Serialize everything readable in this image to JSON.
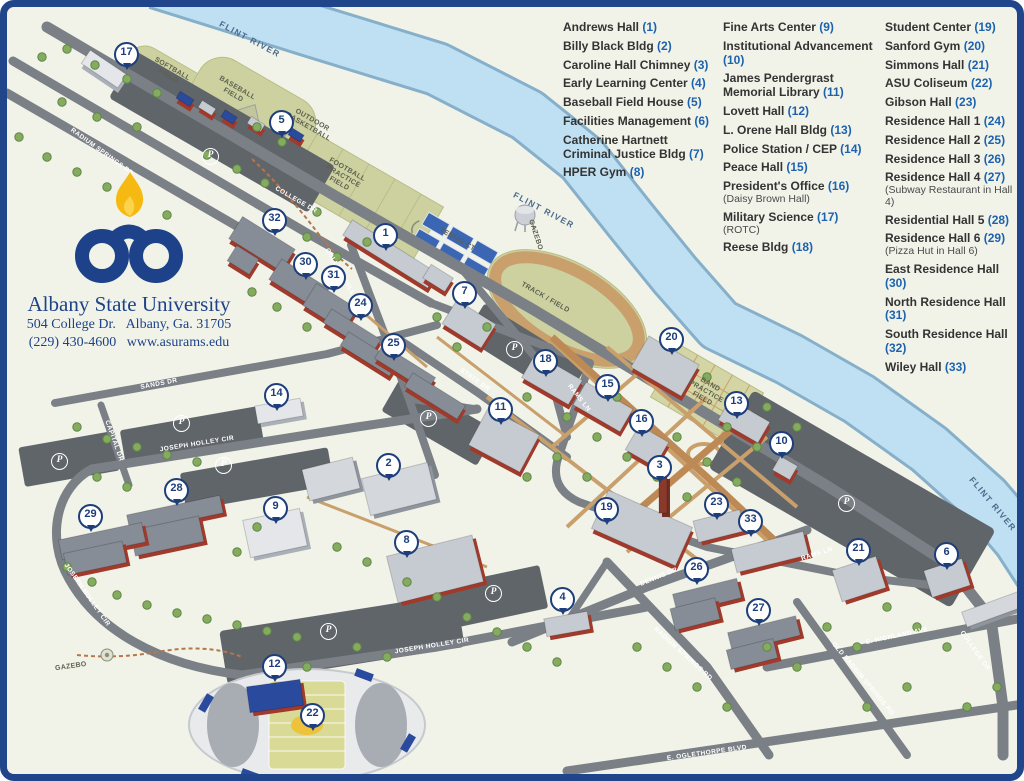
{
  "brand": {
    "title": "Albany State University",
    "address": "504 College Dr.   Albany, Ga. 31705",
    "contact": "(229) 430-4600   www.asurams.edu"
  },
  "colors": {
    "border_navy": "#20458a",
    "logo_navy": "#1d4289",
    "flame_gold": "#f6b912",
    "legend_number_blue": "#1d62ae",
    "legend_name": "#333333",
    "river_fill": "#bfe0f3",
    "river_edge": "#86afc9",
    "road_gray": "#7b8086",
    "parking_gray": "#60656a",
    "field_olive": "#cdd1a0",
    "walkway_tan": "#c9a06b",
    "brick_red": "#a23a2c",
    "roof_gray": "#c6cad1",
    "marker_navy": "#1d3e7a"
  },
  "legend": {
    "columns": [
      {
        "items": [
          {
            "name": "Andrews Hall",
            "num": "1"
          },
          {
            "name": "Billy Black Bldg",
            "num": "2"
          },
          {
            "name": "Caroline Hall Chimney",
            "num": "3"
          },
          {
            "name": "Early Learning Center",
            "num": "4"
          },
          {
            "name": "Baseball Field House",
            "num": "5"
          },
          {
            "name": "Facilities Management",
            "num": "6"
          },
          {
            "name": "Catherine Hartnett Criminal Justice Bldg",
            "num": "7"
          },
          {
            "name": "HPER Gym",
            "num": "8"
          }
        ]
      },
      {
        "items": [
          {
            "name": "Fine Arts Center",
            "num": "9"
          },
          {
            "name": "Institutional Advancement",
            "num": "10"
          },
          {
            "name": "James Pendergrast Memorial Library",
            "num": "11"
          },
          {
            "name": "Lovett Hall",
            "num": "12"
          },
          {
            "name": "L. Orene Hall Bldg",
            "num": "13"
          },
          {
            "name": "Police Station / CEP",
            "num": "14"
          },
          {
            "name": "Peace Hall",
            "num": "15"
          },
          {
            "name": "President's Office",
            "num": "16",
            "note": "(Daisy Brown Hall)"
          },
          {
            "name": "Military Science",
            "num": "17",
            "note": "(ROTC)"
          },
          {
            "name": "Reese Bldg",
            "num": "18"
          }
        ]
      },
      {
        "items": [
          {
            "name": "Student Center",
            "num": "19"
          },
          {
            "name": "Sanford Gym",
            "num": "20"
          },
          {
            "name": "Simmons Hall",
            "num": "21"
          },
          {
            "name": "ASU Coliseum",
            "num": "22"
          },
          {
            "name": "Gibson Hall",
            "num": "23"
          },
          {
            "name": "Residence Hall 1",
            "num": "24"
          },
          {
            "name": "Residence Hall 2",
            "num": "25"
          },
          {
            "name": "Residence Hall 3",
            "num": "26"
          },
          {
            "name": "Residence Hall 4",
            "num": "27",
            "note": "(Subway Restaurant in Hall 4)"
          },
          {
            "name": "Residential Hall 5",
            "num": "28"
          },
          {
            "name": "Residence Hall 6",
            "num": "29",
            "note": "(Pizza Hut in Hall 6)"
          },
          {
            "name": "East Residence Hall",
            "num": "30"
          },
          {
            "name": "North Residence Hall",
            "num": "31"
          },
          {
            "name": "South Residence Hall",
            "num": "32"
          },
          {
            "name": "Wiley Hall",
            "num": "33"
          }
        ]
      }
    ]
  },
  "map": {
    "river_labels": [
      {
        "t": "FLINT RIVER",
        "x": 243,
        "y": 32,
        "r": 28
      },
      {
        "t": "FLINT RIVER",
        "x": 537,
        "y": 203,
        "r": 28
      },
      {
        "t": "FLINT RIVER",
        "x": 986,
        "y": 497,
        "r": 50
      }
    ],
    "road_labels": [
      {
        "t": "RADIUM SPRINGS RD",
        "x": 95,
        "y": 145,
        "r": 36
      },
      {
        "t": "COLLEGE DR",
        "x": 289,
        "y": 193,
        "r": 30
      },
      {
        "t": "COLLEGE HILLS LN",
        "x": 337,
        "y": 272,
        "r": 60
      },
      {
        "t": "SANDS DR",
        "x": 152,
        "y": 377,
        "r": -11
      },
      {
        "t": "CAPITAL DR",
        "x": 107,
        "y": 434,
        "r": 70
      },
      {
        "t": "JOSEPH HOLLEY CIR",
        "x": 190,
        "y": 437,
        "r": -9
      },
      {
        "t": "JOSEPH HOLLEY CIR",
        "x": 80,
        "y": 588,
        "r": 55
      },
      {
        "t": "JOSEPH HOLLEY CIR",
        "x": 425,
        "y": 639,
        "r": -9
      },
      {
        "t": "STATE DR",
        "x": 468,
        "y": 373,
        "r": 35
      },
      {
        "t": "RAMS LN",
        "x": 572,
        "y": 391,
        "r": 52
      },
      {
        "t": "RAMS LN",
        "x": 810,
        "y": 547,
        "r": -18
      },
      {
        "t": "DENNIS DR",
        "x": 652,
        "y": 570,
        "r": -22
      },
      {
        "t": "E. HIGHLAND AVE",
        "x": 890,
        "y": 629,
        "r": -12
      },
      {
        "t": "RADIUM SPRINGS RD",
        "x": 676,
        "y": 647,
        "r": 42
      },
      {
        "t": "OLD RADIUM SPRINGS RD",
        "x": 856,
        "y": 672,
        "r": 50
      },
      {
        "t": "COLLEGE DR",
        "x": 968,
        "y": 644,
        "r": 55
      },
      {
        "t": "E. OGLETHORPE BLVD",
        "x": 700,
        "y": 746,
        "r": -8
      }
    ],
    "field_labels": [
      {
        "t": "SOFTBALL\nFIELD",
        "x": 163,
        "y": 66,
        "r": 30
      },
      {
        "t": "BASEBALL\nFIELD",
        "x": 228,
        "y": 85,
        "r": 30
      },
      {
        "t": "OUTDOOR\nBASKETBALL",
        "x": 303,
        "y": 117,
        "r": 30
      },
      {
        "t": "FOOTBALL\nPRACTICE\nFIELD",
        "x": 336,
        "y": 170,
        "r": 30
      },
      {
        "t": "TENNIS CT",
        "x": 450,
        "y": 233,
        "r": 30
      },
      {
        "t": "TRACK / FIELD",
        "x": 538,
        "y": 291,
        "r": 30
      },
      {
        "t": "BAND\nPRACTICE\nFIELD",
        "x": 699,
        "y": 385,
        "r": 30
      },
      {
        "t": "GAZEBO",
        "x": 528,
        "y": 228,
        "r": 72
      },
      {
        "t": "GAZEBO",
        "x": 64,
        "y": 660,
        "r": -8
      }
    ],
    "parking_symbol": "P",
    "parking": [
      {
        "x": 204,
        "y": 150
      },
      {
        "x": 53,
        "y": 455
      },
      {
        "x": 175,
        "y": 417
      },
      {
        "x": 217,
        "y": 459
      },
      {
        "x": 322,
        "y": 625
      },
      {
        "x": 422,
        "y": 412
      },
      {
        "x": 487,
        "y": 587
      },
      {
        "x": 508,
        "y": 343
      },
      {
        "x": 840,
        "y": 497
      }
    ],
    "markers": [
      {
        "n": 1,
        "x": 377,
        "y": 228
      },
      {
        "n": 2,
        "x": 380,
        "y": 458
      },
      {
        "n": 3,
        "x": 651,
        "y": 460
      },
      {
        "n": 4,
        "x": 554,
        "y": 592
      },
      {
        "n": 5,
        "x": 273,
        "y": 115
      },
      {
        "n": 6,
        "x": 938,
        "y": 547
      },
      {
        "n": 7,
        "x": 456,
        "y": 286
      },
      {
        "n": 8,
        "x": 398,
        "y": 535
      },
      {
        "n": 9,
        "x": 267,
        "y": 501
      },
      {
        "n": 10,
        "x": 773,
        "y": 436
      },
      {
        "n": 11,
        "x": 492,
        "y": 402
      },
      {
        "n": 12,
        "x": 266,
        "y": 659
      },
      {
        "n": 13,
        "x": 728,
        "y": 396
      },
      {
        "n": 14,
        "x": 268,
        "y": 388
      },
      {
        "n": 15,
        "x": 599,
        "y": 379
      },
      {
        "n": 16,
        "x": 633,
        "y": 414
      },
      {
        "n": 17,
        "x": 118,
        "y": 47
      },
      {
        "n": 18,
        "x": 537,
        "y": 354
      },
      {
        "n": 19,
        "x": 598,
        "y": 502
      },
      {
        "n": 20,
        "x": 663,
        "y": 332
      },
      {
        "n": 21,
        "x": 850,
        "y": 543
      },
      {
        "n": 22,
        "x": 304,
        "y": 708
      },
      {
        "n": 23,
        "x": 708,
        "y": 497
      },
      {
        "n": 24,
        "x": 352,
        "y": 298
      },
      {
        "n": 25,
        "x": 385,
        "y": 338
      },
      {
        "n": 26,
        "x": 688,
        "y": 562
      },
      {
        "n": 27,
        "x": 750,
        "y": 603
      },
      {
        "n": 28,
        "x": 168,
        "y": 483
      },
      {
        "n": 29,
        "x": 82,
        "y": 509
      },
      {
        "n": 30,
        "x": 297,
        "y": 257
      },
      {
        "n": 31,
        "x": 325,
        "y": 270
      },
      {
        "n": 32,
        "x": 266,
        "y": 213
      },
      {
        "n": 33,
        "x": 742,
        "y": 514
      }
    ]
  }
}
